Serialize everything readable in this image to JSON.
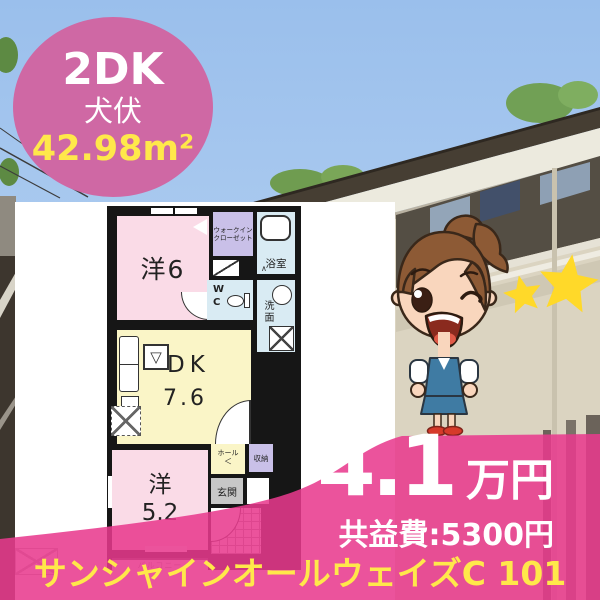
{
  "badge": {
    "layout": "2DK",
    "location": "犬伏",
    "area": "42.98m²"
  },
  "floorplan": {
    "room_yo6": "洋6",
    "wic_line1": "ウォークイン",
    "wic_line2": "クローゼット",
    "bath": "浴室",
    "wc_w": "W",
    "wc_c": "C",
    "washroom": "洗面",
    "dk": "DK",
    "dk_size": "7.6",
    "yo5": "洋",
    "yo5_size": "5.2",
    "hall": "ホール",
    "storage": "収納",
    "entrance": "玄関",
    "balcony": "バルコニー",
    "sink_symbol": "▽",
    "hall_arrow": "＜",
    "bath_mark": "∧"
  },
  "price": {
    "rent": "4.1",
    "unit": "万円",
    "fee": "共益費:5300円"
  },
  "property": {
    "name": "サンシャインオールウェイズC 101"
  },
  "colors": {
    "badge-pink": "#cf68a4",
    "overlay-pink": "rgba(232,58,141,0.87)",
    "accent-yellow": "#ffe84a",
    "room-pink": "#fadbe7",
    "room-yellow": "#faf5c7",
    "room-purple": "#c9c0e8",
    "room-blue": "#d9ebf3",
    "room-gray": "#c7c7c7",
    "wall-black": "#161616",
    "hair-brown": "#8d5a35",
    "skin": "#f9d6bd",
    "outfit-blue": "#3f7ba3",
    "shoe-red": "#d63a2a",
    "star-yellow": "#ffd929",
    "sky-top": "#9abfec",
    "sky-bottom": "#bdd7f2"
  }
}
